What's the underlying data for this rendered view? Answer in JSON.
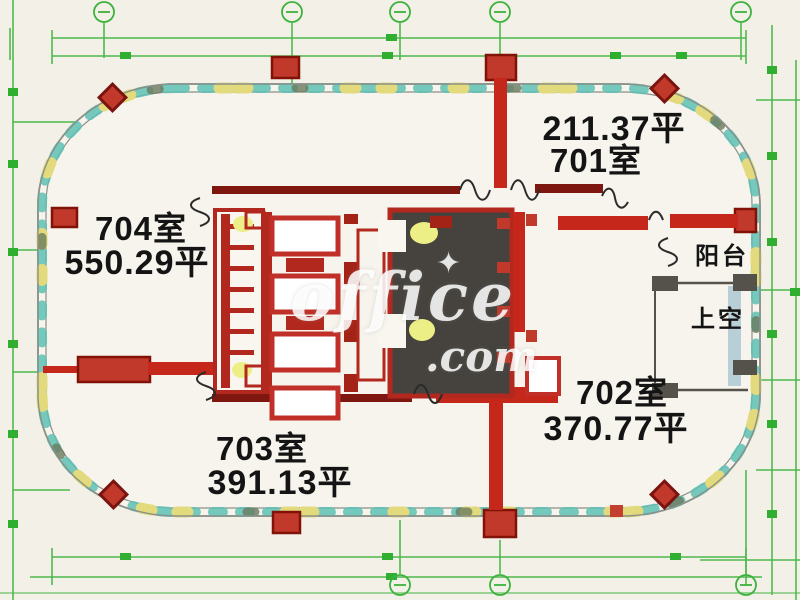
{
  "document": {
    "type": "office-floor-plan",
    "floor": "7F"
  },
  "rooms": [
    {
      "name": "701室",
      "area": "211.37平"
    },
    {
      "name": "702室",
      "area": "370.77平"
    },
    {
      "name": "703室",
      "area": "391.13平"
    },
    {
      "name": "704室",
      "area": "550.29平"
    }
  ],
  "annotations": {
    "balcony": "阳台",
    "void_above": "上空"
  },
  "watermark": {
    "word": "office",
    "tld": ".com",
    "sparkle": "✦"
  },
  "colors": {
    "background": "#f2f0e7",
    "wall_red": "#c5281a",
    "wall_dark_red": "#7e1710",
    "marker_red": "#c0392b",
    "grid_green": "#3db23d",
    "clip_teal": "#5ec0b4",
    "clip_yellow": "#e2da7c",
    "shaft_dark": "#46433e",
    "lamp_yellow": "#ecef86",
    "outline_gray": "#8b9089",
    "glass_blue": "#b8cfd8"
  }
}
